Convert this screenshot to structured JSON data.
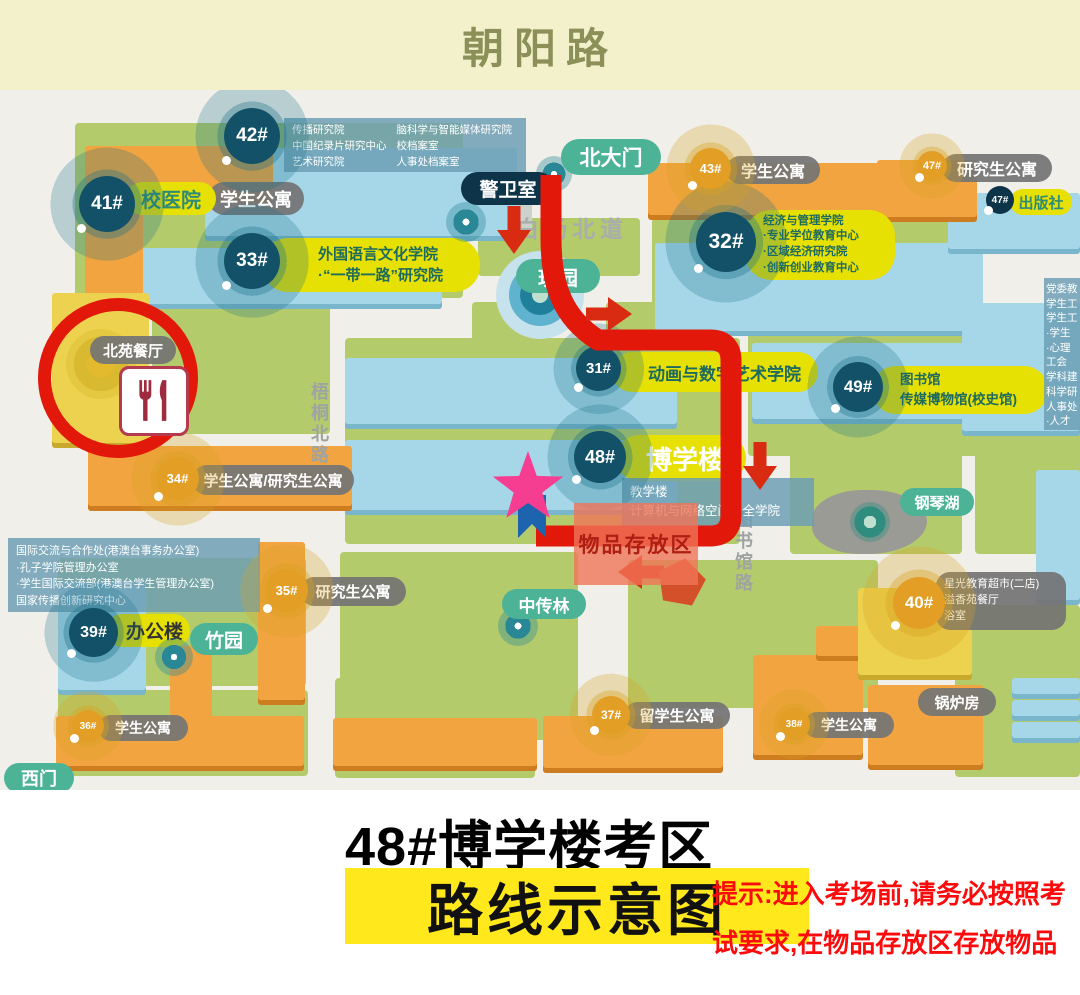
{
  "header": {
    "road": "朝阳路"
  },
  "roads": {
    "baiyang": "白杨北道",
    "wutong": "梧桐北路",
    "tushuguan": "图书馆路"
  },
  "gates": {
    "north": "北大门",
    "west": "西门"
  },
  "spots": {
    "guard": "警卫室",
    "meiyuan": "玫园",
    "zhuyuan": "竹园",
    "zhongchuanlin": "中传林",
    "gangqinhu": "钢琴湖",
    "canteen": "北苑餐厅",
    "boiler": "锅炉房"
  },
  "buildings": {
    "b42": {
      "num": "42#",
      "left": [
        "传播研究院",
        "中国纪录片研究中心",
        "艺术研究院"
      ],
      "right": [
        "脑科学与智能媒体研究院",
        "校档案室",
        "人事处档案室"
      ]
    },
    "b41": {
      "num": "41#",
      "name": "校医院",
      "dorm": "学生公寓"
    },
    "b33": {
      "num": "33#",
      "lines": [
        "外国语言文化学院",
        "·“一带一路”研究院"
      ]
    },
    "b43": {
      "num": "43#",
      "name": "学生公寓"
    },
    "b47dorm": {
      "num": "47#",
      "name": "研究生公寓"
    },
    "b47press": {
      "num": "47#",
      "name": "出版社"
    },
    "b32": {
      "num": "32#",
      "lines": [
        "经济与管理学院",
        "·专业学位教育中心",
        "·区域经济研究院",
        "·创新创业教育中心"
      ]
    },
    "b31": {
      "num": "31#",
      "name": "动画与数字艺术学院"
    },
    "b48": {
      "num": "48#",
      "name": "博学楼",
      "lines": [
        "教学楼",
        "计算机与网络空间安全学院"
      ]
    },
    "b49": {
      "num": "49#",
      "lines": [
        "图书馆",
        "传媒博物馆(校史馆)"
      ]
    },
    "b34": {
      "num": "34#",
      "name": "学生公寓/研究生公寓"
    },
    "b35": {
      "num": "35#",
      "name": "研究生公寓"
    },
    "b39": {
      "num": "39#",
      "name": "办公楼"
    },
    "b40": {
      "num": "40#",
      "lines": [
        "星光教育超市(二店)",
        "溢香苑餐厅",
        "浴室"
      ]
    },
    "b36": {
      "num": "36#",
      "name": "学生公寓"
    },
    "b37": {
      "num": "37#",
      "name": "留学生公寓"
    },
    "b38": {
      "num": "38#",
      "name": "学生公寓"
    }
  },
  "info_blocks": {
    "intl": [
      "国际交流与合作处(港澳台事务办公室)",
      "·孔子学院管理办公室",
      "·学生国际交流部(港澳台学生管理办公室)",
      "国家传播创新研究中心"
    ],
    "right_edge": [
      "党委教",
      "学生工",
      "学生工",
      "·学生",
      "·心理",
      "工会",
      "学科建",
      "科学研",
      "人事处",
      "·人才"
    ]
  },
  "route": {
    "storage_label": "物品存放区",
    "color": "#e2180b"
  },
  "colors": {
    "route_red": "#e2180b",
    "star_pink": "#f53e91",
    "pin_blue": "#1e63ae",
    "highlight_yellow": "#ffe81c",
    "hint_red": "#fb0b0b",
    "marker_navy": "#0d3448",
    "marker_orange": "#f39b2d"
  },
  "footer": {
    "title": "48#博学楼考区",
    "highlight": "路线示意图",
    "hint1": "提示:进入考场前,请务必按照考",
    "hint2": "试要求,在物品存放区存放物品"
  }
}
